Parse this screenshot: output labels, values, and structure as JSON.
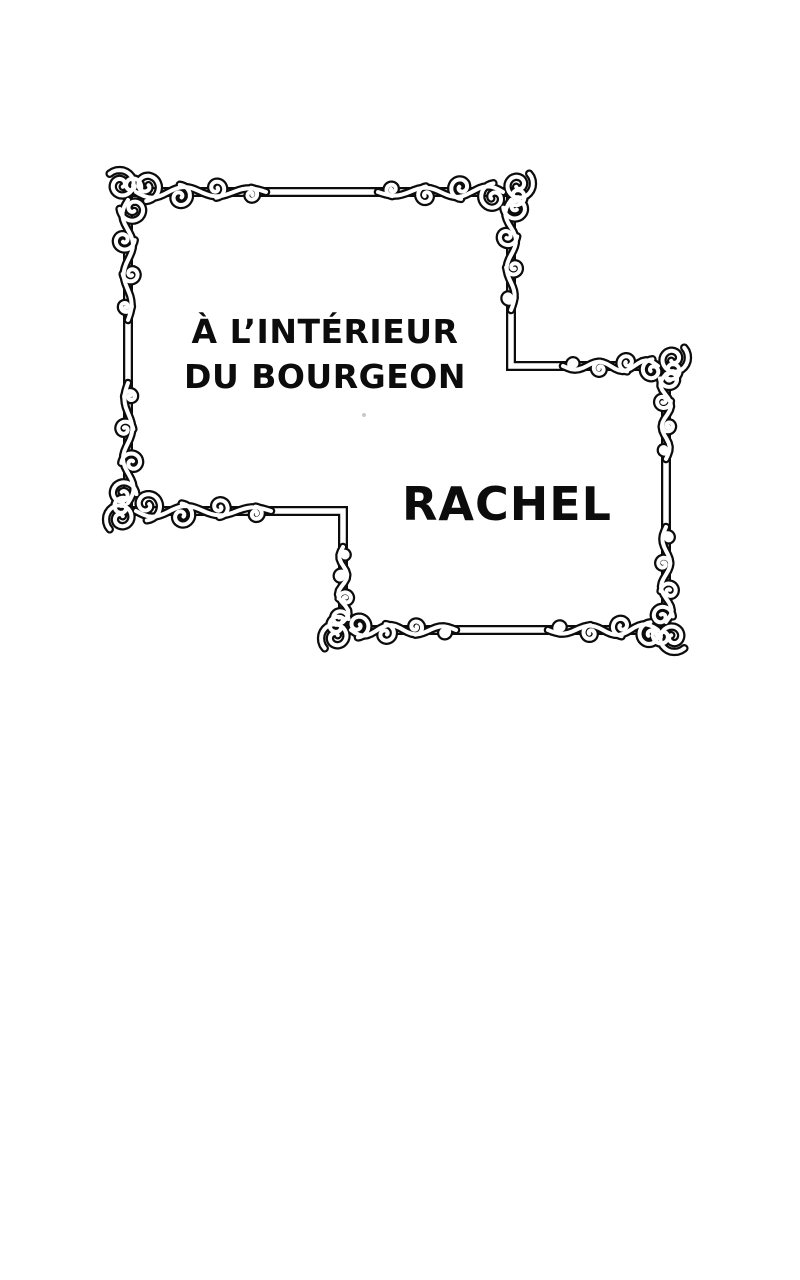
{
  "page": {
    "background_color": "#ffffff",
    "ink_color": "#0c0c0c"
  },
  "panel": {
    "title_line1": "À L’INTÉRIEUR",
    "title_line2": "DU BOURGEON",
    "character_name": "RACHEL"
  }
}
